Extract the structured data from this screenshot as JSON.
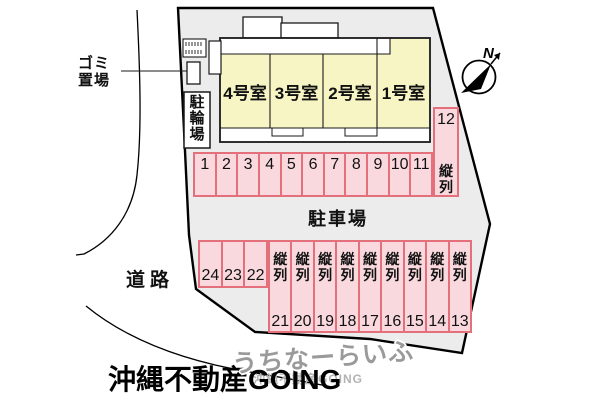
{
  "plan": {
    "compass_label": "N",
    "labels": {
      "garbage_line1": "ゴミ",
      "garbage_line2": "置場",
      "bicycle_parking": "駐輪場",
      "road": "道路",
      "parking_lot": "駐車場"
    },
    "building": {
      "rooms": [
        {
          "label": "4号室"
        },
        {
          "label": "3号室"
        },
        {
          "label": "2号室"
        },
        {
          "label": "1号室"
        }
      ]
    },
    "parking": {
      "tandem_label": "縦列",
      "row1_numbers": [
        "1",
        "2",
        "3",
        "4",
        "5",
        "6",
        "7",
        "8",
        "9",
        "10",
        "11"
      ],
      "space12_number": "12",
      "row2_short_numbers": [
        "24",
        "23",
        "22"
      ],
      "row2_tandem_numbers": [
        "21",
        "20",
        "19",
        "18",
        "17",
        "16",
        "15",
        "14",
        "13"
      ]
    },
    "watermark": {
      "main": "うちなーらいふ",
      "sub": "沖縄不動産GOING"
    },
    "logo": "沖縄不動産GOING",
    "colors": {
      "site_fill": "#ececec",
      "room_fill": "#f8f5c5",
      "parking_fill": "#f9d9de",
      "parking_border": "#e4707c"
    }
  }
}
